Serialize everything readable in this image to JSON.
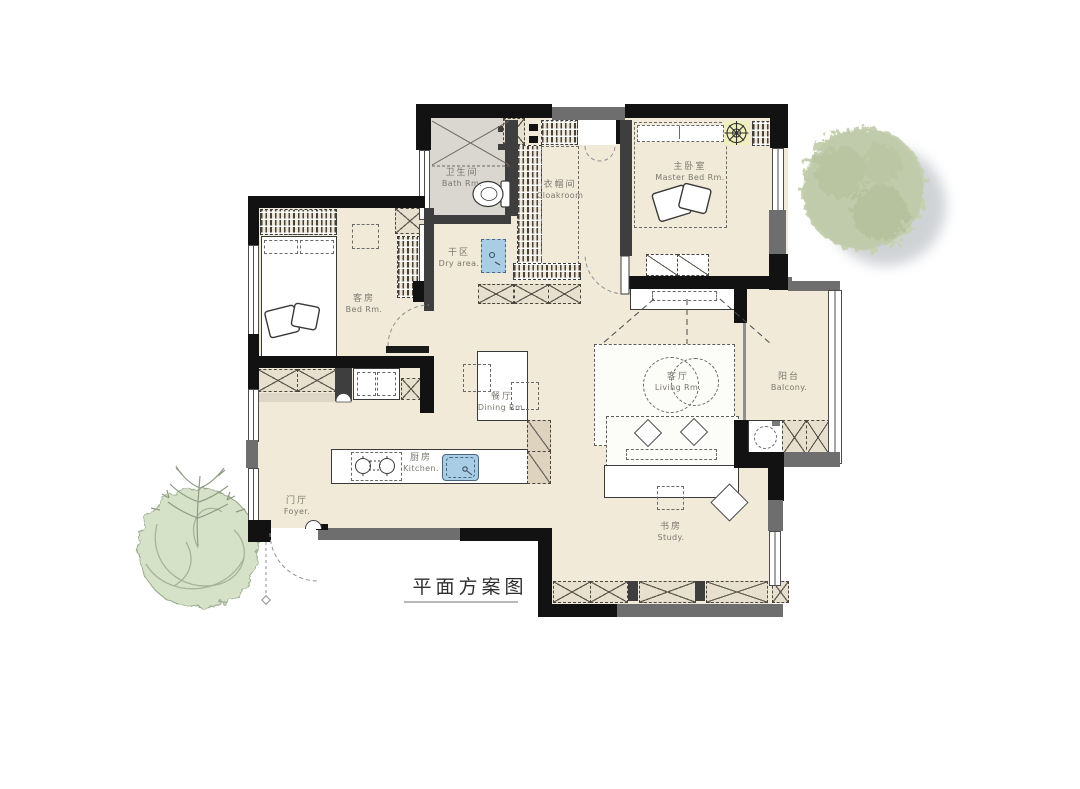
{
  "title": {
    "text": "平面方案图"
  },
  "rooms": {
    "bath": {
      "zh": "卫生间",
      "en": "Bath Rm."
    },
    "cloakroom": {
      "zh": "衣帽间",
      "en": "Cloakroom"
    },
    "master_bed": {
      "zh": "主卧室",
      "en": "Master Bed Rm."
    },
    "dry_area": {
      "zh": "干区",
      "en": "Dry area."
    },
    "guest_bed": {
      "zh": "客房",
      "en": "Bed Rm."
    },
    "dining": {
      "zh": "餐厅",
      "en": "Dining Rm."
    },
    "living": {
      "zh": "客厅",
      "en": "Living Rm."
    },
    "balcony": {
      "zh": "阳台",
      "en": "Balcony."
    },
    "kitchen": {
      "zh": "厨房",
      "en": "Kitchen."
    },
    "foyer": {
      "zh": "门厅",
      "en": "Foyer."
    },
    "study": {
      "zh": "书房",
      "en": "Study."
    }
  },
  "colors": {
    "floor": "#f1ead9",
    "bath_floor": "#d9d7d0",
    "wall_dark": "#121212",
    "wall_gray": "#6e6e6e",
    "cabinet_tan": "#e7e0ce",
    "fixture_blue": "#a9cde5",
    "tree_green": "#c7d1af",
    "plant_green": "#d6e2c8"
  },
  "icons": {
    "tree": "tree-canopy-icon",
    "plant": "leafy-plant-icon",
    "ceiling_light": "ceiling-light-icon"
  }
}
